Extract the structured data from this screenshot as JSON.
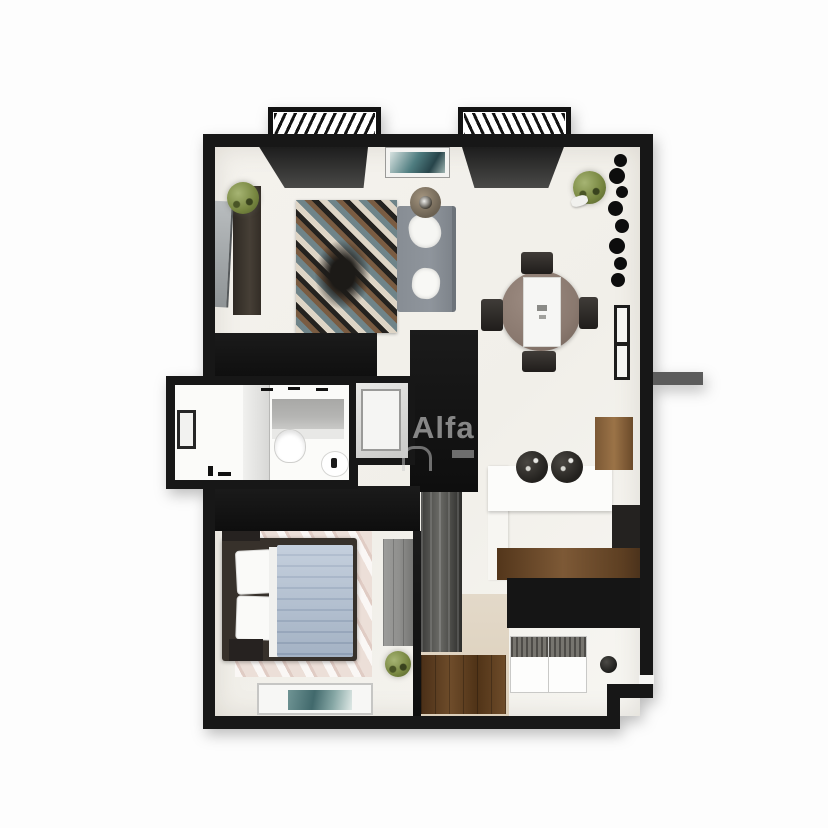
{
  "watermark": {
    "text": "Alfa"
  },
  "palette": {
    "bg": "#fdfdfd",
    "wall": "#171717",
    "floor_a": "#f4f2ed",
    "floor_b": "#f1efe9",
    "entry_floor": "#dccfba",
    "window_top": "#1d1d1d",
    "window_bottom": "#4a4a48",
    "wood_light": "#9b7347",
    "wood_mid": "#7b5835",
    "wood_dark": "#53361b",
    "counter_black": "#151515",
    "sofa": "#8f959c",
    "duvet": "#aebdd0",
    "duvet_line": "#98a9c0",
    "marble": "#ecdfd8",
    "plant": "#76853f",
    "wardrobe": "#8f8f8d",
    "rug_teal": "#6f8489",
    "rug_cream": "#ded5c6",
    "rug_brown": "#7a5c42",
    "rug_dark": "#1c1a17",
    "art_teal": "#4f7d80",
    "stool": "#23211e",
    "stub_gray": "#5c5c5c",
    "bath_gray": "#b5b5b3",
    "watermark": "rgba(206,206,206,0.62)"
  },
  "inventory": {
    "living_room": [
      "balcony",
      "window-panel",
      "wall-art",
      "tv-console",
      "tv-screen",
      "plant",
      "area-rug",
      "sofa",
      "throw-blanket",
      "pillow",
      "round-side-table"
    ],
    "dining_area": [
      "balcony",
      "window-panel",
      "round-table",
      "table-runner",
      "chair",
      "chair",
      "chair",
      "chair",
      "plant",
      "wall-decor-branches",
      "interior-door"
    ],
    "bathroom": [
      "vanity-mirror",
      "faucet-marks",
      "partition-wall",
      "toilet",
      "sink",
      "door-niche",
      "floor-hardware"
    ],
    "shower_room": [
      "shower-cabin"
    ],
    "bedroom": [
      "double-bed",
      "pillows",
      "duvet",
      "nightstand",
      "nightstand",
      "marble-rug",
      "wardrobe",
      "plant",
      "floor-mat-art"
    ],
    "kitchen": [
      "breakfast-bar",
      "bar-stool",
      "bar-stool",
      "wall-cabinet",
      "tall-unit",
      "wood-counter",
      "counter-base",
      "sink-unit",
      "stove-unit",
      "knob",
      "base-cabinets"
    ],
    "hallway": [
      "mirror-closet",
      "entry-cabinets",
      "corridor-stub"
    ]
  }
}
